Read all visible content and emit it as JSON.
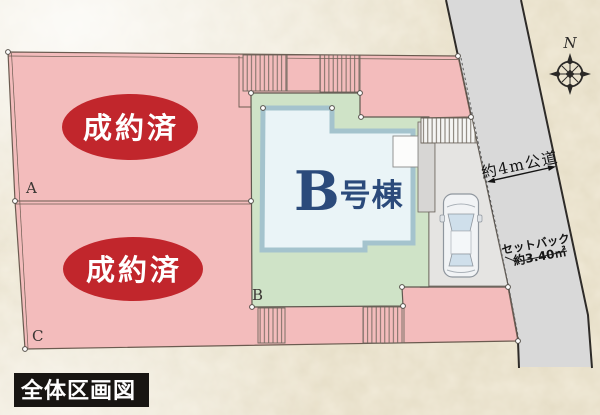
{
  "plan": {
    "title": "全体区画図",
    "compass": {
      "north": "N"
    },
    "road": {
      "label": "約4m公道"
    },
    "setback": {
      "line1": "セットバック",
      "line2": "約3.40㎡"
    },
    "building": {
      "name_main": "B",
      "name_suffix": "号棟"
    },
    "lots": {
      "a": {
        "label": "A",
        "status": "成約済"
      },
      "b": {
        "label": "B"
      },
      "c": {
        "label": "C",
        "status": "成約済"
      }
    },
    "colors": {
      "lot_pink": "#f3bcbc",
      "lot_green": "#cfe3c7",
      "building_fill": "#eaf4f7",
      "building_border": "#a4c3cd",
      "sold_red": "#c1262c",
      "road_gray": "#d9d9d9",
      "label_navy": "#2b4a7b",
      "text_white": "#ffffff",
      "title_bg": "#181512"
    }
  }
}
